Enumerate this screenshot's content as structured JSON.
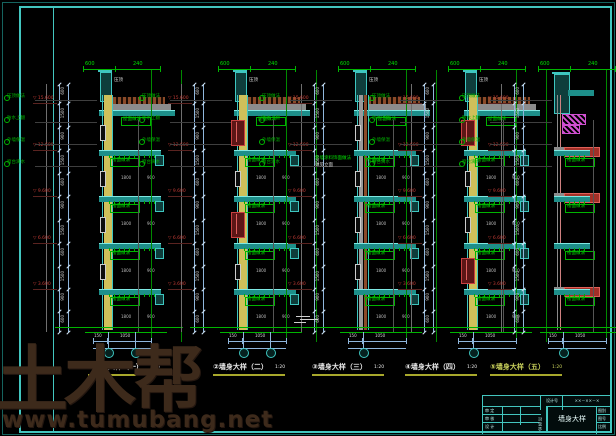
{
  "watermark": {
    "logo": "土木帮",
    "url": "www.tumubang.net"
  },
  "sections": [
    {
      "prefix": "①",
      "title": "墙身大样（一）",
      "scale": "1:20",
      "x": 105,
      "style": "yellow",
      "bubbles": 2,
      "title_x": 88,
      "title_color": "#e8e8e8"
    },
    {
      "prefix": "②",
      "title": "墙身大样（二）",
      "scale": "1:20",
      "x": 240,
      "style": "yellow-window",
      "bubbles": 2,
      "title_x": 213,
      "title_color": "#e8e8e8"
    },
    {
      "prefix": "③",
      "title": "墙身大样（三）",
      "scale": "1:20",
      "x": 360,
      "style": "framed",
      "bubbles": 1,
      "title_x": 312,
      "title_color": "#e8e8e8"
    },
    {
      "prefix": "④",
      "title": "墙身大样（四）",
      "scale": "1:20",
      "x": 470,
      "style": "yellow-window",
      "bubbles": 1,
      "title_x": 405,
      "title_color": "#e8e8e8"
    },
    {
      "prefix": "⑤",
      "title": "墙身大样（五）",
      "scale": "1:20",
      "x": 560,
      "style": "brick",
      "bubbles": 1,
      "title_x": 490,
      "title_color": "#c9d15b"
    }
  ],
  "levels": [
    "15.600",
    "12.600",
    "9.600",
    "6.600",
    "3.600"
  ],
  "level_prefix": "▽",
  "chain_dims": [
    "600",
    "1500",
    "900",
    "1500",
    "600",
    "900",
    "1500",
    "600",
    "1500",
    "900",
    "600"
  ],
  "left_annotations": [
    "压顶做法",
    "防水上翻",
    "外墙保温",
    "窗台滴水"
  ],
  "roof_label": "屋面做法",
  "slab_label": "楼面做法",
  "parapet_label": "压顶",
  "top_dim": "600",
  "top_dim2": "240",
  "mid_dims": [
    "1800",
    "900"
  ],
  "ground_dims": [
    "150",
    "1050"
  ],
  "s3_note": "外墙涂料饰面做法",
  "s3_note2": "详见立面",
  "title_block": {
    "design_no_label": "设计号",
    "design_no": "××－××－×",
    "rows": [
      "审 定",
      "审 核",
      "设 计"
    ],
    "sign_strip": "会签栏",
    "drawing_name": "墙身大样",
    "right_cells": [
      "图别",
      "图号",
      "比例"
    ]
  }
}
